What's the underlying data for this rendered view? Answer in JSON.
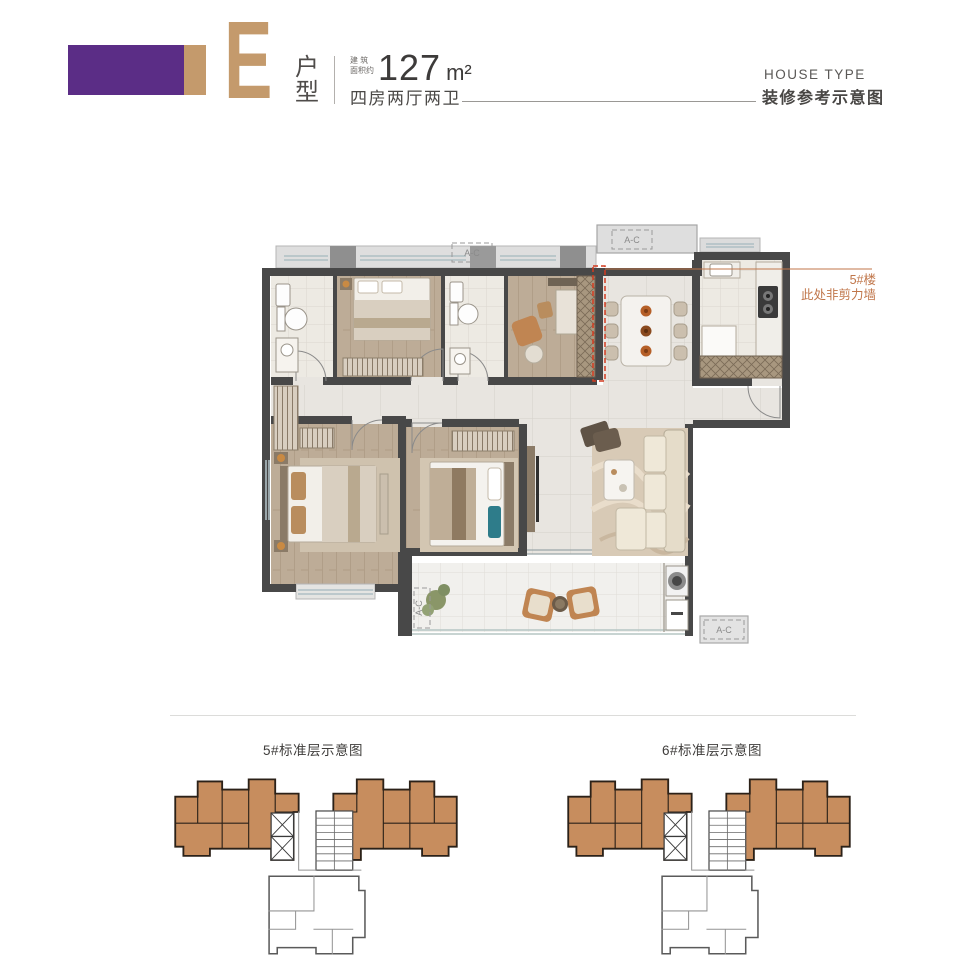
{
  "theme": {
    "purple": "#5b2d86",
    "tan": "#c49a6c",
    "orange": "#c0764a",
    "red": "#d23b20",
    "planOrange": "#c78d5e",
    "wall": "#484848"
  },
  "header": {
    "letter": "E",
    "typeLabel": "户型",
    "areaPrefixLine1": "建 筑",
    "areaPrefixLine2": "面积约",
    "areaValue": "127",
    "areaUnit": "m²",
    "layoutText": "四房两厅两卫",
    "houseTypeEn": "HOUSE TYPE",
    "subtitle": "装修参考示意图"
  },
  "plan": {
    "annotationLine1": "5#楼",
    "annotationLine2": "此处非剪力墙",
    "acLabels": [
      "A-C",
      "A-C",
      "A-C",
      "A-C"
    ]
  },
  "footer": {
    "leftCaption": "5#标准层示意图",
    "rightCaption": "6#标准层示意图"
  }
}
